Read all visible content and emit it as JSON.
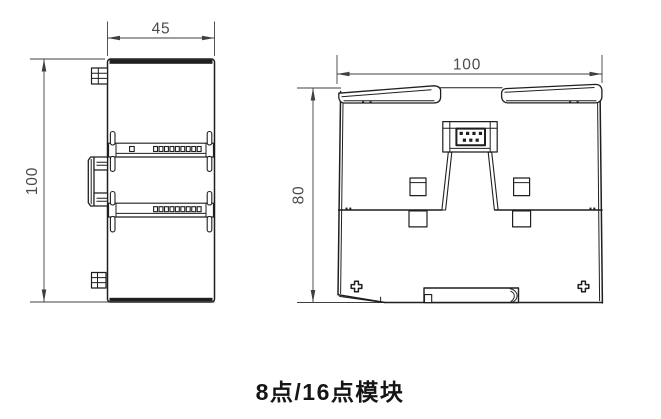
{
  "caption": "8点/16点模块",
  "colors": {
    "background": "#ffffff",
    "line": "#1f1f1f",
    "dim_line": "#3f3f3f",
    "dim_text": "#4b4b4b",
    "caption_text": "#151515"
  },
  "side_view": {
    "width_dim_label": "45",
    "height_dim_label": "100",
    "single_slot_upper": 1,
    "terminal_slot_count_upper": 9,
    "terminal_slot_count_lower": 9
  },
  "rear_view": {
    "width_dim_label": "100",
    "height_dim_label": "80",
    "connector_pins_top_row": 4,
    "connector_pins_bottom_row": 3,
    "screw_count": 2
  }
}
